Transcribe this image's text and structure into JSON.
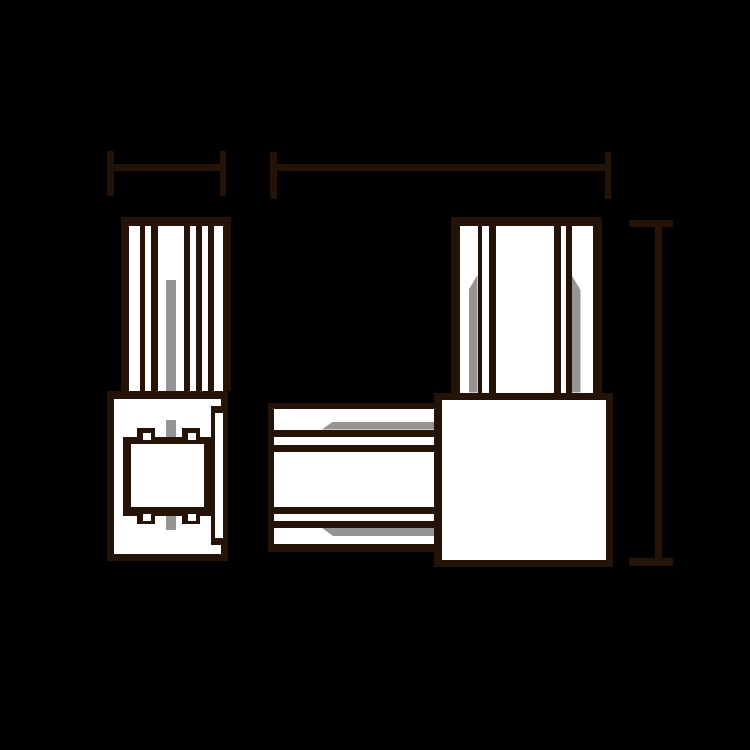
{
  "canvas": {
    "width": 750,
    "height": 750,
    "background": "#000000"
  },
  "palette": {
    "outline": "#251307",
    "fill": "#ffffff",
    "accent_gray": "#949494",
    "background": "#000000"
  },
  "drawing": {
    "description": "Two-view technical line drawing of a track connector: left side view with ribbed housing over connector body, right front view of L-shaped assembly (vertical ribbed riser, square junction block, horizontal ribbed tube), with three unlabeled dimension lines",
    "groups": [
      {
        "name": "left-side-view",
        "shapes": [
          {
            "name": "ribbed-housing-outline",
            "x": 121,
            "y": 217,
            "w": 110,
            "h": 174,
            "fill": "outline"
          },
          {
            "name": "housing-stripe-white-1",
            "x": 129,
            "y": 225.5,
            "w": 10.5,
            "h": 165.5,
            "fill": "fill"
          },
          {
            "name": "housing-stripe-white-2",
            "x": 144.5,
            "y": 225.5,
            "w": 6.5,
            "h": 165.5,
            "fill": "fill"
          },
          {
            "name": "housing-stripe-white-center",
            "x": 158,
            "y": 225.5,
            "w": 26,
            "h": 165.5,
            "fill": "fill"
          },
          {
            "name": "housing-stripe-white-4",
            "x": 190,
            "y": 225.5,
            "w": 6,
            "h": 165.5,
            "fill": "fill"
          },
          {
            "name": "housing-stripe-white-5",
            "x": 201.5,
            "y": 225.5,
            "w": 6.5,
            "h": 165.5,
            "fill": "fill"
          },
          {
            "name": "housing-stripe-white-6",
            "x": 213.5,
            "y": 225.5,
            "w": 9.5,
            "h": 165.5,
            "fill": "fill"
          },
          {
            "name": "center-rail-gray-upper",
            "x": 165.5,
            "y": 280,
            "w": 10,
            "h": 111,
            "fill": "accent_gray"
          },
          {
            "name": "body-outline",
            "x": 107,
            "y": 391,
            "w": 121,
            "h": 170,
            "fill": "outline"
          },
          {
            "name": "body-interior",
            "x": 114,
            "y": 398.5,
            "w": 107,
            "h": 155,
            "fill": "fill"
          },
          {
            "name": "side-strip-outline",
            "x": 210.5,
            "y": 405.5,
            "w": 17.5,
            "h": 139,
            "fill": "outline"
          },
          {
            "name": "side-strip-channel",
            "x": 215,
            "y": 413,
            "w": 7.5,
            "h": 124.5,
            "fill": "fill"
          },
          {
            "name": "center-rail-gray-mid",
            "x": 165.5,
            "y": 420,
            "w": 10,
            "h": 16.5,
            "fill": "accent_gray"
          },
          {
            "name": "center-rail-gray-lower",
            "x": 165.5,
            "y": 515.5,
            "w": 10,
            "h": 14.5,
            "fill": "accent_gray"
          },
          {
            "name": "clip-tab-top-left",
            "x": 136.5,
            "y": 427.5,
            "w": 18.5,
            "h": 16.5,
            "fill": "outline"
          },
          {
            "name": "clip-tab-top-right",
            "x": 181.5,
            "y": 427.5,
            "w": 18.5,
            "h": 16.5,
            "fill": "outline"
          },
          {
            "name": "clip-tab-bottom-left",
            "x": 136.5,
            "y": 507,
            "w": 18.5,
            "h": 16.5,
            "fill": "outline"
          },
          {
            "name": "clip-tab-bottom-right",
            "x": 181.5,
            "y": 507,
            "w": 18.5,
            "h": 16.5,
            "fill": "outline"
          },
          {
            "name": "connector-block-outline",
            "x": 123,
            "y": 436.5,
            "w": 88,
            "h": 79,
            "fill": "outline"
          },
          {
            "name": "connector-block-interior",
            "x": 130.5,
            "y": 444,
            "w": 73,
            "h": 63,
            "fill": "fill"
          },
          {
            "name": "tab-notch-top-left",
            "x": 143,
            "y": 433,
            "w": 8,
            "h": 7,
            "fill": "fill"
          },
          {
            "name": "tab-notch-top-right",
            "x": 187.5,
            "y": 433,
            "w": 8,
            "h": 7,
            "fill": "fill"
          },
          {
            "name": "tab-notch-bottom-left",
            "x": 143,
            "y": 513.5,
            "w": 8,
            "h": 7.5,
            "fill": "fill"
          },
          {
            "name": "tab-notch-bottom-right",
            "x": 187.5,
            "y": 513.5,
            "w": 8,
            "h": 7.5,
            "fill": "fill"
          }
        ]
      },
      {
        "name": "front-view",
        "shapes": [
          {
            "name": "riser-outline",
            "x": 450.5,
            "y": 217,
            "w": 151,
            "h": 175.5,
            "fill": "outline"
          },
          {
            "name": "riser-stripe-white-1",
            "x": 459.5,
            "y": 225.5,
            "w": 18,
            "h": 167,
            "fill": "fill"
          },
          {
            "name": "riser-stripe-white-2",
            "x": 481.5,
            "y": 225.5,
            "w": 7,
            "h": 167,
            "fill": "fill"
          },
          {
            "name": "riser-stripe-white-center",
            "x": 496,
            "y": 225.5,
            "w": 58,
            "h": 167,
            "fill": "fill"
          },
          {
            "name": "riser-stripe-white-4",
            "x": 560.5,
            "y": 225.5,
            "w": 5.5,
            "h": 167,
            "fill": "fill"
          },
          {
            "name": "riser-stripe-white-5",
            "x": 571.5,
            "y": 225.5,
            "w": 21.5,
            "h": 167,
            "fill": "fill"
          },
          {
            "name": "riser-gray-left",
            "x": 468.5,
            "y": 275,
            "w": 9,
            "h": 117.5,
            "fill": "accent_gray",
            "clip": "polygon(0px 15px, 100% 0px, 100% 100%, 0px 100%)"
          },
          {
            "name": "riser-gray-right",
            "x": 571.5,
            "y": 275,
            "w": 9,
            "h": 117.5,
            "fill": "accent_gray",
            "clip": "polygon(0px 0px, 100% 15px, 100% 100%, 0px 100%)"
          },
          {
            "name": "tube-outline",
            "x": 267.5,
            "y": 402.5,
            "w": 173.5,
            "h": 149,
            "fill": "outline"
          },
          {
            "name": "tube-band-white-1",
            "x": 274,
            "y": 409,
            "w": 167,
            "h": 20.5,
            "fill": "fill"
          },
          {
            "name": "tube-band-white-2",
            "x": 274,
            "y": 437,
            "w": 167,
            "h": 7.5,
            "fill": "fill"
          },
          {
            "name": "tube-band-white-center",
            "x": 274,
            "y": 451.5,
            "w": 167,
            "h": 55,
            "fill": "fill"
          },
          {
            "name": "tube-band-white-4",
            "x": 274,
            "y": 514,
            "w": 167,
            "h": 7,
            "fill": "fill"
          },
          {
            "name": "tube-band-white-5",
            "x": 274,
            "y": 528,
            "w": 167,
            "h": 16,
            "fill": "fill"
          },
          {
            "name": "tube-gray-top",
            "x": 322,
            "y": 421.5,
            "w": 119,
            "h": 8,
            "fill": "accent_gray",
            "clip": "polygon(0px 100%, 11px 0px, 100% 0px, 100% 100%)"
          },
          {
            "name": "tube-gray-bottom",
            "x": 322,
            "y": 528,
            "w": 119,
            "h": 8,
            "fill": "accent_gray",
            "clip": "polygon(0px 0px, 100% 0px, 100% 100%, 11px 100%)"
          },
          {
            "name": "junction-square-outline",
            "x": 434,
            "y": 392.5,
            "w": 179,
            "h": 174.5,
            "fill": "outline"
          },
          {
            "name": "junction-square-interior",
            "x": 441.5,
            "y": 400,
            "w": 164,
            "h": 159.5,
            "fill": "fill"
          }
        ]
      },
      {
        "name": "dimension-lines",
        "shapes": [
          {
            "name": "width-dim-left-bar",
            "x": 107,
            "y": 164,
            "w": 119,
            "h": 7,
            "fill": "outline"
          },
          {
            "name": "width-dim-left-tick-start",
            "x": 107,
            "y": 151,
            "w": 6.5,
            "h": 45,
            "fill": "outline"
          },
          {
            "name": "width-dim-left-tick-end",
            "x": 219.5,
            "y": 151,
            "w": 6.5,
            "h": 45,
            "fill": "outline"
          },
          {
            "name": "width-dim-right-bar",
            "x": 270,
            "y": 164,
            "w": 341,
            "h": 7,
            "fill": "outline"
          },
          {
            "name": "width-dim-right-tick-start",
            "x": 270,
            "y": 152,
            "w": 6.5,
            "h": 47,
            "fill": "outline"
          },
          {
            "name": "width-dim-right-tick-end",
            "x": 604.5,
            "y": 152,
            "w": 6.5,
            "h": 47,
            "fill": "outline"
          },
          {
            "name": "height-dim-line",
            "x": 655,
            "y": 223.5,
            "w": 6.5,
            "h": 338,
            "fill": "outline"
          },
          {
            "name": "height-dim-tick-top",
            "x": 629,
            "y": 220,
            "w": 44,
            "h": 7,
            "fill": "outline"
          },
          {
            "name": "height-dim-tick-bottom",
            "x": 629,
            "y": 558,
            "w": 44,
            "h": 7.5,
            "fill": "outline"
          }
        ]
      }
    ]
  }
}
